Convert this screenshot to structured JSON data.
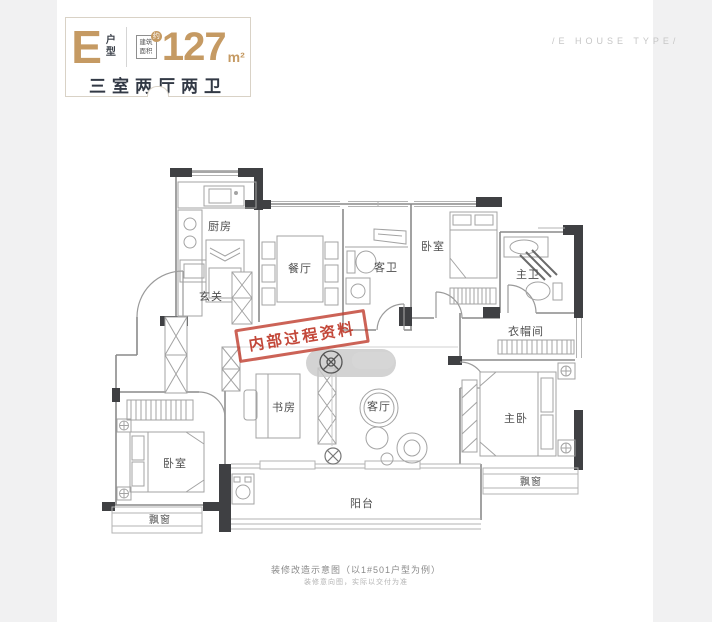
{
  "colors": {
    "accent_gold": "#c59a63",
    "wall_dark": "#3f4043",
    "stamp_red": "#bf3b2c",
    "line_gray": "#9a9a9a"
  },
  "header": {
    "type_letter": "E",
    "type_label_vertical": "户型",
    "area_label_line1": "建筑",
    "area_label_line2": "面积",
    "area_approx": "约",
    "area_value": "127",
    "area_unit": "m²",
    "summary": "三室两厅两卫"
  },
  "corner_caption": "/E HOUSE TYPE/",
  "stamp": {
    "text": "内部过程资料"
  },
  "rooms": [
    {
      "id": "kitchen",
      "label": "厨房"
    },
    {
      "id": "dining",
      "label": "餐厅"
    },
    {
      "id": "guest-bath",
      "label": "客卫"
    },
    {
      "id": "bedroom-top",
      "label": "卧室"
    },
    {
      "id": "master-bath",
      "label": "主卫"
    },
    {
      "id": "foyer",
      "label": "玄关"
    },
    {
      "id": "cloakroom",
      "label": "衣帽间"
    },
    {
      "id": "study",
      "label": "书房"
    },
    {
      "id": "living",
      "label": "客厅"
    },
    {
      "id": "master-bedroom",
      "label": "主卧"
    },
    {
      "id": "bedroom-left",
      "label": "卧室"
    },
    {
      "id": "bay-window-left",
      "label": "飘窗"
    },
    {
      "id": "bay-window-right",
      "label": "飘窗"
    },
    {
      "id": "balcony",
      "label": "阳台"
    }
  ],
  "captions": {
    "line1": "装修改造示意图（以1#501户型为例）",
    "line2": "装修意向图，实际以交付为准"
  }
}
